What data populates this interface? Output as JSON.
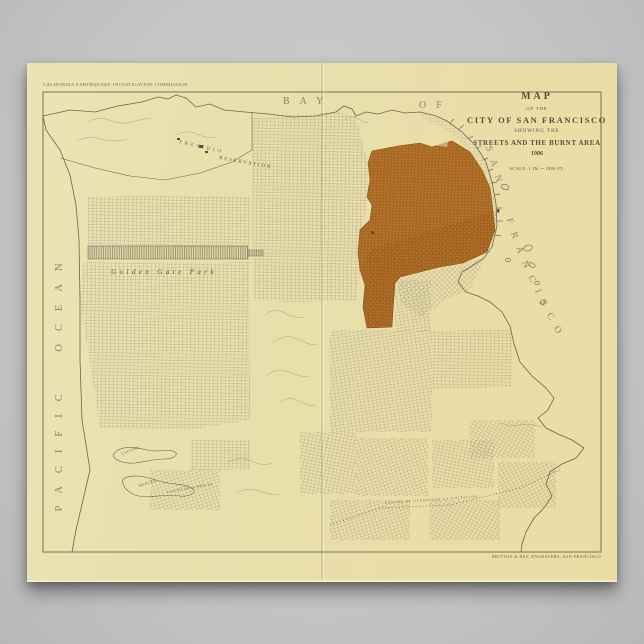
{
  "scene": {
    "background_color": "#c6c6c6"
  },
  "poster": {
    "paper_color": "#eae0ac",
    "caption": "CALIFORNIA EARTHQUAKE INVESTIGATION COMMISSION",
    "imprint": "BRITTON & REY, ENGRAVERS, SAN FRANCISCO"
  },
  "title_block": {
    "word1": "MAP",
    "word2": "OF THE",
    "word3": "CITY OF SAN FRANCISCO",
    "word4": "SHOWING THE",
    "word5": "STREETS AND THE BURNT AREA",
    "year": "1906",
    "scale": "SCALE: 1 IN. = 1800 FT."
  },
  "water_labels": {
    "bay": "BAY",
    "of": "OF",
    "san_francisco": "SAN FRANCISCO",
    "pacific_ocean": "PACIFIC OCEAN"
  },
  "land_labels": {
    "presidio_line1": "PRESIDIO",
    "presidio_line2": "RESERVATION",
    "golden_gate_park": "Golden Gate Park",
    "lake_upper": "LAGUNA",
    "lake_lower": "MERCED",
    "lake_full": "LAGUNA DE LA MERCED",
    "rancho_boundary": "CANADA DE GUADALUPE LA VISITACION"
  },
  "map_colors": {
    "burnt_area": "#b4722b",
    "burnt_street_line": "#7c4511",
    "street_line": "#756e5b",
    "coast_line": "#6b6554",
    "border_line": "#6b654c"
  }
}
